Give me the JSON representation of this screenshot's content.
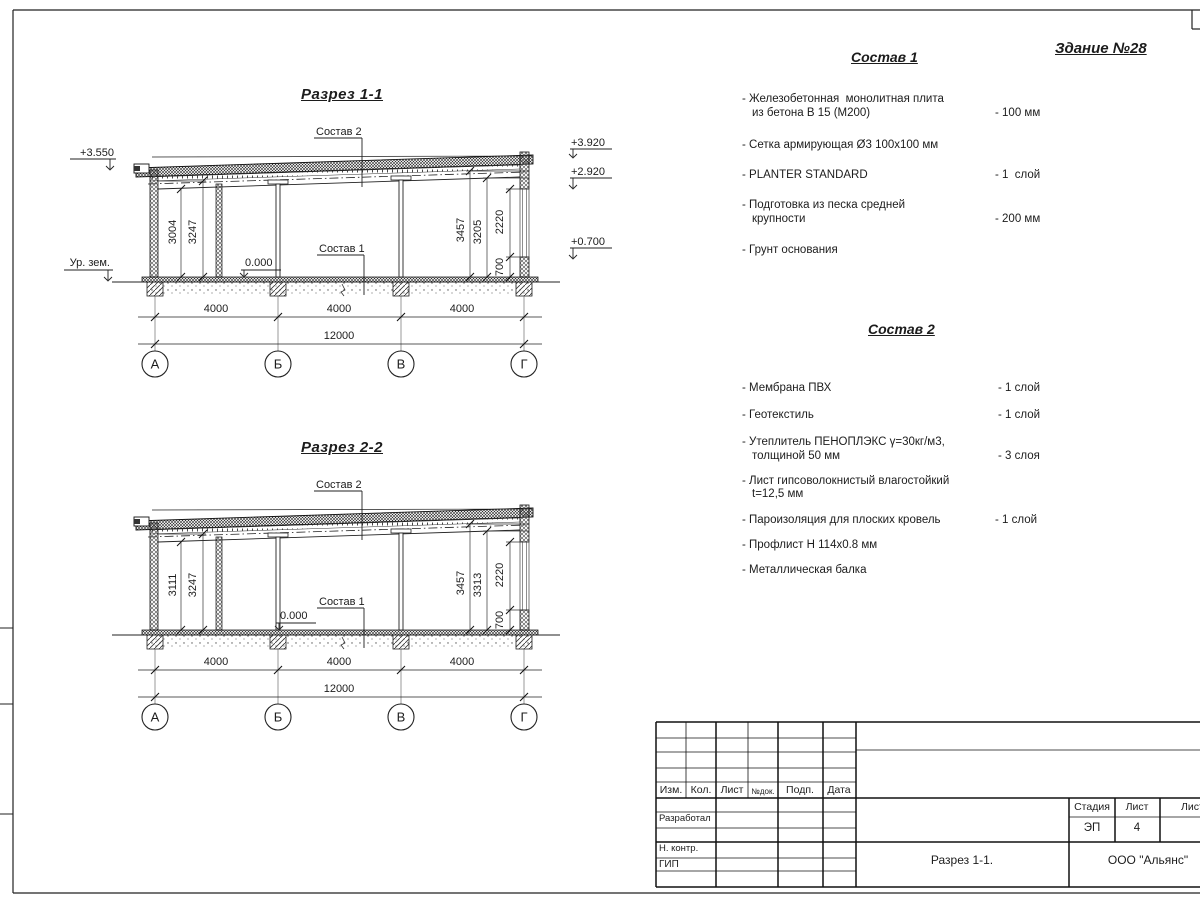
{
  "sheet": {
    "building_title": "Здание №28"
  },
  "sections": [
    {
      "title": "Разрез 1-1",
      "callout_top": "Состав 2",
      "callout_bottom": "Состав 1",
      "zero_mark": "0.000",
      "ground_label": "Ур. зем.",
      "elev_roof_left": "+3.550",
      "elev_right_top": "+3.920",
      "elev_right_mid": "+2.920",
      "elev_right_low": "+0.700",
      "dims_left": [
        "3004",
        "3247"
      ],
      "dims_right": [
        "3457",
        "3205",
        "2220",
        "700"
      ],
      "dims_bottom": [
        "4000",
        "4000",
        "4000"
      ],
      "dim_total": "12000",
      "axes": [
        "А",
        "Б",
        "В",
        "Г"
      ]
    },
    {
      "title": "Разрез 2-2",
      "callout_top": "Состав 2",
      "callout_bottom": "Состав 1",
      "zero_mark": "0.000",
      "dims_left": [
        "3111",
        "3247"
      ],
      "dims_right": [
        "3457",
        "3313",
        "2220",
        "700"
      ],
      "dims_bottom": [
        "4000",
        "4000",
        "4000"
      ],
      "dim_total": "12000",
      "axes": [
        "А",
        "Б",
        "В",
        "Г"
      ]
    }
  ],
  "composition1": {
    "title": "Состав 1",
    "items": [
      {
        "line1": "- Железобетонная  монолитная плита",
        "line2": "из бетона В 15 (М200)",
        "value": "- 100 мм"
      },
      {
        "line1": "- Сетка армирующая Ø3 100х100 мм",
        "line2": "",
        "value": ""
      },
      {
        "line1": "- PLANTER STANDARD",
        "line2": "",
        "value": "- 1  слой"
      },
      {
        "line1": "- Подготовка из песка средней",
        "line2": "крупности",
        "value": "- 200 мм"
      },
      {
        "line1": "- Грунт основания",
        "line2": "",
        "value": ""
      }
    ]
  },
  "composition2": {
    "title": "Состав 2",
    "items": [
      {
        "line1": "- Мембрана ПВХ",
        "line2": "",
        "value": "- 1 слой"
      },
      {
        "line1": "- Геотекстиль",
        "line2": "",
        "value": "- 1 слой"
      },
      {
        "line1": "- Утеплитель ПЕНОПЛЭКС γ=30кг/м3,",
        "line2": "толщиной 50 мм",
        "value": "- 3 слоя"
      },
      {
        "line1": "- Лист гипсоволокнистый влагостойкий",
        "line2": "t=12,5 мм",
        "value": ""
      },
      {
        "line1": "- Пароизоляция для плоских кровель",
        "line2": "",
        "value": "- 1 слой"
      },
      {
        "line1": "- Профлист Н 114х0.8 мм",
        "line2": "",
        "value": ""
      },
      {
        "line1": "- Металлическая балка",
        "line2": "",
        "value": ""
      }
    ]
  },
  "title_block": {
    "header_cols": [
      "Изм.",
      "Кол.",
      "Лист",
      "№док.",
      "Подп.",
      "Дата"
    ],
    "row_labels": [
      "Разработал",
      "Н. контр.",
      "ГИП"
    ],
    "stage_label": "Стадия",
    "sheet_label": "Лист",
    "sheets_label": "Листов",
    "stage_value": "ЭП",
    "sheet_value": "4",
    "doc_title": "Разрез 1-1.",
    "company": "ООО \"Альянс\""
  }
}
